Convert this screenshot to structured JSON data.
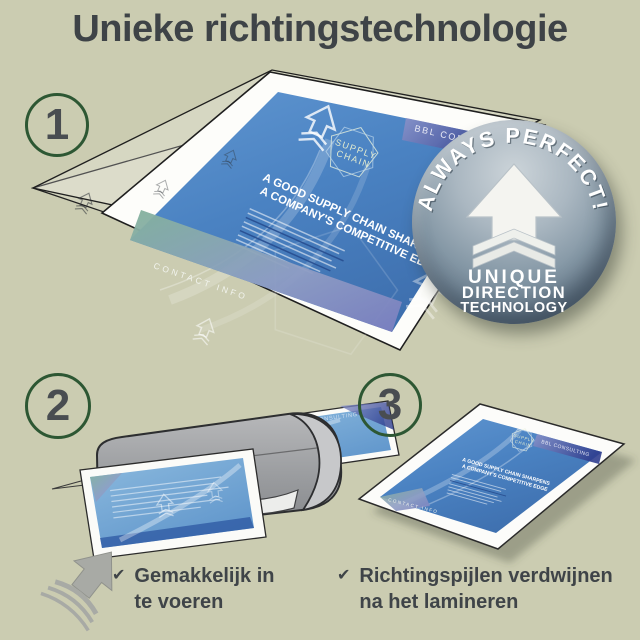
{
  "title": "Unieke richtingstechnologie",
  "steps": [
    {
      "number": "1"
    },
    {
      "number": "2"
    },
    {
      "number": "3"
    }
  ],
  "badge": {
    "arc_text": "ALWAYS PERFECT!",
    "line1": "UNIQUE",
    "line2": "DIRECTION",
    "line3": "TECHNOLOGY"
  },
  "document": {
    "brand": "BBL CONSULTING",
    "logo_line1": "SUPPLY",
    "logo_line2": "CHAIN",
    "headline_line1": "A GOOD SUPPLY CHAIN SHARPENS",
    "headline_line2": "A COMPANY'S COMPETITIVE EDGE",
    "footer": "CONTACT INFO"
  },
  "captions": [
    {
      "check": "✔",
      "text": "Gemakkelijk in te voeren"
    },
    {
      "check": "✔",
      "text": "Richtingspijlen verdwijnen na het lamineren"
    }
  ],
  "colors": {
    "background": "#cbccb1",
    "text": "#3e4347",
    "step_ring_green": "#2d5733",
    "document_blue": "#4d86c5",
    "badge_gray": "#8497a5",
    "laminator_gray": "#9fa1a3",
    "arrow_gray": "#a8aaa5"
  }
}
